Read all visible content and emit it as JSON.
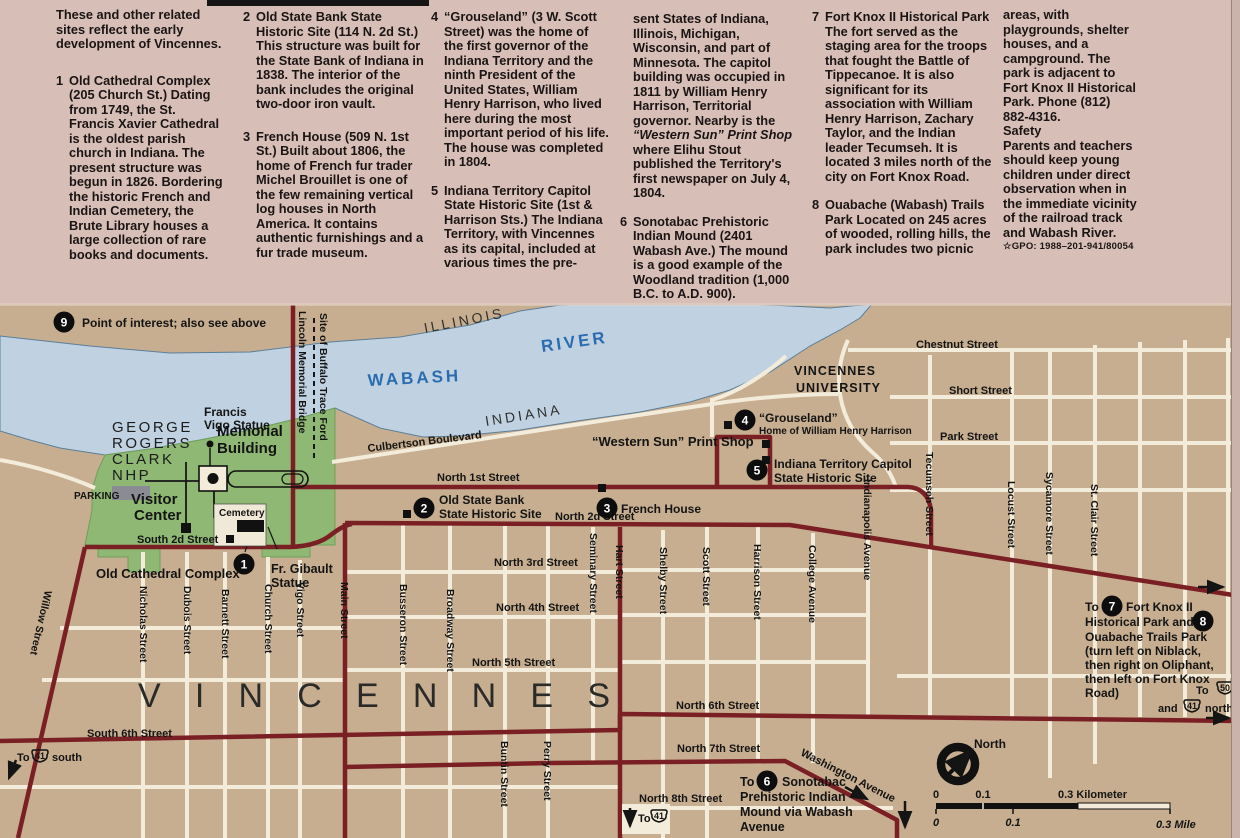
{
  "panel": {
    "col1": {
      "intro": "These and other related sites reflect the early development of Vincennes.",
      "e1": {
        "num": "1",
        "name": "Old Cathedral Complex",
        "text": "(205 Church St.) Dating from 1749, the St. Francis Xavier Cathedral is the oldest parish church in Indiana. The present structure was begun in 1826. Bordering the historic French and Indian Cemetery, the Brute Library houses a large collection of rare books and documents."
      }
    },
    "col2": {
      "e2": {
        "num": "2",
        "name": "Old State Bank State Historic Site",
        "text": "(114 N. 2d St.) This structure was built for the State Bank of Indiana in 1838. The interior of the bank includes the original two-door iron vault."
      },
      "e3": {
        "num": "3",
        "name": "French House",
        "text": "(509 N. 1st St.) Built about 1806, the home of French fur trader Michel Brouillet is one of the few remaining vertical log houses in North America. It contains authentic furnishings and a fur trade museum."
      }
    },
    "col3": {
      "e4": {
        "num": "4",
        "name": "“Grouseland”",
        "text": "(3 W. Scott Street) was the home of the first governor of the Indiana Territory and the ninth President of the United States, William Henry Harrison, who lived here during the most important period of his life. The house was completed in 1804."
      },
      "e5": {
        "num": "5",
        "name": "Indiana Territory Capitol State Historic Site",
        "text": "(1st & Harrison Sts.) The Indiana Territory, with Vincennes as its capital, included at various times the pre-"
      }
    },
    "col4": {
      "cont": {
        "pre": "sent States of Indiana, Illinois, Michigan, Wisconsin, and part of Minnesota. The capitol building was occupied in 1811 by William Henry Harrison, Territorial governor. Nearby is the ",
        "italic": "“Western Sun” Print Shop",
        "post": " where Elihu Stout published the Territory's first newspaper on July 4, 1804."
      },
      "e6": {
        "num": "6",
        "name": "Sonotabac Prehistoric Indian Mound",
        "text": "(2401 Wabash Ave.) The mound is a good example of the Woodland tradition (1,000 B.C. to A.D. 900)."
      }
    },
    "col5": {
      "e7": {
        "num": "7",
        "name": "Fort Knox II Historical Park",
        "text": "The fort served as the staging area for the troops that fought the Battle of Tippecanoe. It is also significant for its association with William Henry Harrison, Zachary Taylor, and the Indian leader Tecumseh. It is located 3 miles north of the city on Fort Knox Road."
      },
      "e8": {
        "num": "8",
        "name": "Ouabache (Wabash) Trails Park",
        "text": "Located on 245 acres of wooded, rolling hills, the park includes two picnic"
      }
    },
    "col6": {
      "p1": "areas, with playgrounds, shelter houses, and a campground. The park is adjacent to Fort Knox II Historical Park. Phone (812) 882-4316.",
      "safety_title": "Safety",
      "safety": "Parents and teachers should keep young children under direct observation when in the immediate vicinity of the railroad track and Wabash River.",
      "gpo": "☆GPO: 1988–201-941/80054"
    }
  },
  "map": {
    "legend9": {
      "num": "9",
      "text": "Point of interest; also see above"
    },
    "water": {
      "wabash": "WABASH",
      "river": "RIVER"
    },
    "states": {
      "illinois": "ILLINOIS",
      "indiana": "INDIANA"
    },
    "park": {
      "l1": "GEORGE",
      "l2": "ROGERS",
      "l3": "CLARK",
      "l4": "NHP"
    },
    "places": {
      "francis_vigo_1": "Francis",
      "francis_vigo_2": "Vigo Statue",
      "memorial_1": "Memorial",
      "memorial_2": "Building",
      "visitor_1": "Visitor",
      "visitor_2": "Center",
      "parking": "PARKING",
      "cemetery": "Cemetery",
      "old_cathedral": "Old Cathedral Complex",
      "fr_gibault_1": "Fr. Gibault",
      "fr_gibault_2": "Statue",
      "site2_1": "Old State Bank",
      "site2_2": "State Historic Site",
      "site3": "French House",
      "site4_1": "“Grouseland”",
      "site4_2": "Home of William Henry Harrison",
      "western_sun": "“Western Sun” Print Shop",
      "site5_1": "Indiana Territory Capitol",
      "site5_2": "State Historic Site",
      "vu_1": "VINCENNES",
      "vu_2": "UNIVERSITY",
      "city": "VINCENNES"
    },
    "sites": {
      "n1": "1",
      "n2": "2",
      "n3": "3",
      "n4": "4",
      "n5": "5",
      "n6": "6",
      "n7": "7",
      "n8": "8",
      "n9": "9"
    },
    "streets": {
      "nicholas": "Nicholas Street",
      "dubois": "Dubois Street",
      "barnett": "Barnett Street",
      "church": "Church Street",
      "vigo": "Vigo Street",
      "main": "Main Street",
      "busseron": "Busseron Street",
      "broadway": "Broadway Street",
      "seminary": "Seminary Street",
      "hart": "Hart Street",
      "shelby": "Shelby Street",
      "scott": "Scott Street",
      "harrison": "Harrison Street",
      "college": "College Avenue",
      "indianapolis": "Indianapolis Avenue",
      "tecumseh": "Tecumseh Street",
      "locust": "Locust Street",
      "sycamore": "Sycamore Street",
      "stclair": "St. Clair Street",
      "buntin": "Buntin Street",
      "perry": "Perry Street",
      "willow": "Willow Street",
      "lincoln": "Lincoln Memorial Bridge",
      "buffalo": "Site of Buffalo Trace Ford",
      "culbertson": "Culbertson Boulevard",
      "s2d": "South 2d Street",
      "n1st": "North 1st Street",
      "n2d": "North 2d Street",
      "n3rd": "North 3rd Street",
      "n4th": "North 4th Street",
      "n5th": "North 5th Street",
      "s6th": "South 6th Street",
      "n6th": "North 6th Street",
      "n7th": "North 7th Street",
      "n8th": "North 8th Street",
      "washington": "Washington Avenue",
      "chestnut": "Chestnut Street",
      "short": "Short Street",
      "park": "Park Street"
    },
    "notes": {
      "sonotabac": {
        "pre": "To",
        "l1": "Sonotabac",
        "l2": "Prehistoric Indian",
        "l3": "Mound via Wabash",
        "l4": "Avenue"
      },
      "fortknox": {
        "pre": "To",
        "l1": "Fort Knox II",
        "l2": "Historical Park and",
        "l3": "Ouabache Trails Park",
        "l4": "(turn left on Niblack,",
        "l5": "then right on Oliphant,",
        "l6": "then left on Fort Knox",
        "l7": "Road)"
      },
      "to41s": {
        "to": "To",
        "num": "41",
        "dir": "south"
      },
      "to41b": {
        "to": "To",
        "num": "41"
      },
      "to50": {
        "to": "To",
        "num50": "50",
        "and": "and",
        "num41": "41",
        "dir": "north"
      }
    },
    "compass": {
      "north": "North"
    },
    "scale": {
      "k0": "0",
      "k1": "0.1",
      "k3": "0.3 Kilometer",
      "m0": "0",
      "m1": "0.1",
      "m3": "0.3 Mile"
    }
  },
  "colors": {
    "road_major": "#7a2024",
    "river": "#c0d2e2",
    "park_green": "#8eb873",
    "land": "#c7ae90",
    "panel": "#d7bfb7"
  }
}
